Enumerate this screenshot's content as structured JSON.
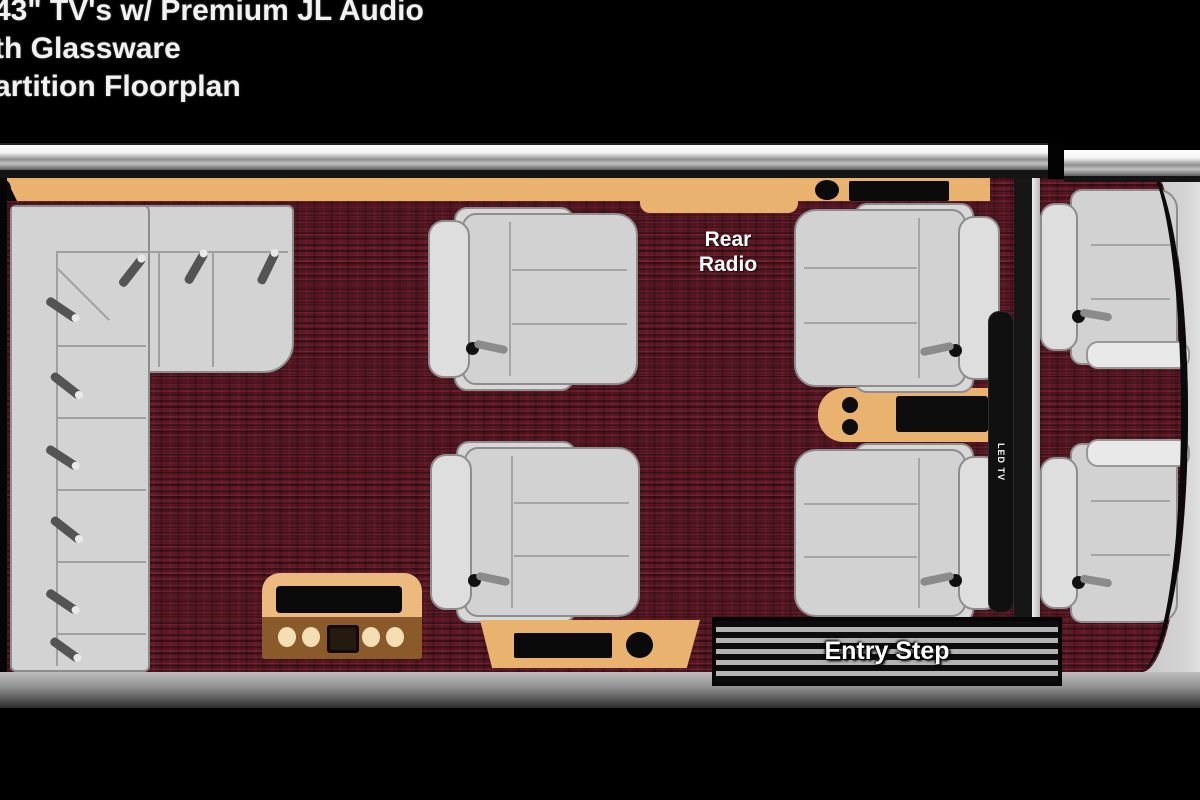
{
  "title": {
    "lines": [
      "43\" TV's w/ Premium JL Audio",
      "th Glassware",
      "artition Floorplan"
    ]
  },
  "floorplan": {
    "rear_radio": [
      "Rear",
      "Radio"
    ],
    "led_tv": "LED TV",
    "entry_step": "Entry Step",
    "colors": {
      "background": "#000000",
      "carpet_maroon": "#571621",
      "counter_tan": "#e9b26f",
      "cabinet_band_brown": "#8a5a2b",
      "cupholder_cream": "#f4deb4",
      "seat_gray": "#d2d2d2",
      "wall_highlight": "#ffffff"
    }
  }
}
